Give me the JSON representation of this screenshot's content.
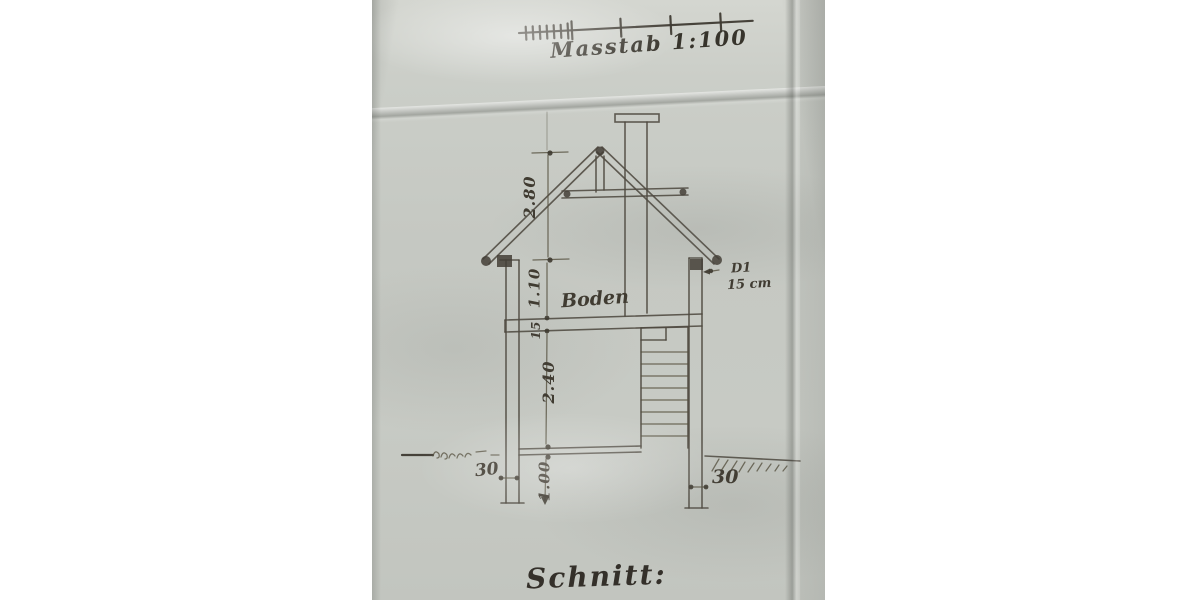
{
  "scale_bar": {
    "label": "Masstab 1:100"
  },
  "labels": {
    "floor": "Boden",
    "title": "Schnitt:"
  },
  "dimensions": {
    "roof_height": "2.80",
    "upper_wall": "1.10",
    "floor_thickness": "15",
    "room_height": "2.40",
    "foundation_depth": "1.00",
    "foundation_width_left": "30",
    "foundation_width_right": "30",
    "eave_note_line1": "D1",
    "eave_note_line2": "15 cm"
  },
  "colors": {
    "paper": "#c6c9c3",
    "ink": "#4f4940",
    "ink_dark": "#3e3a32",
    "background": "#ffffff"
  }
}
